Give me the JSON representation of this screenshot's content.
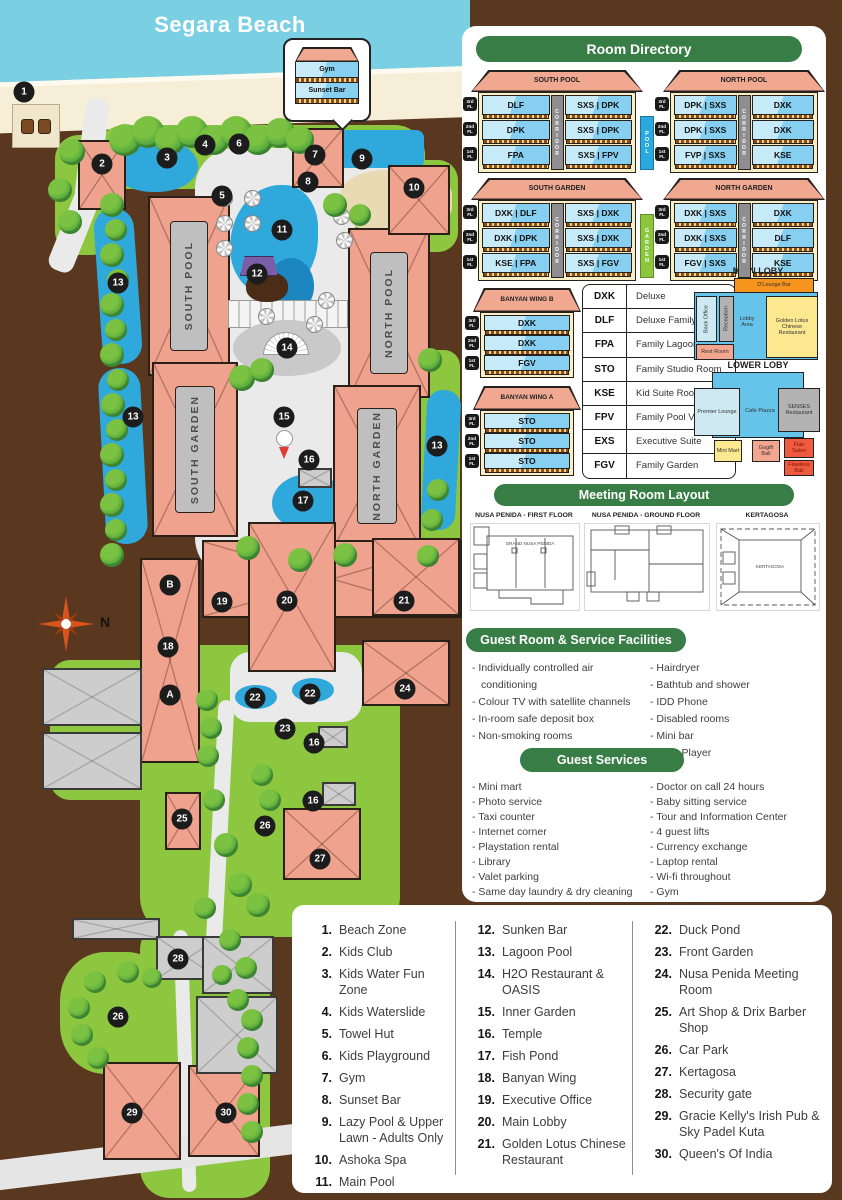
{
  "map": {
    "beach_label": "Segara Beach",
    "compass_label": "N",
    "callout_rows": [
      "Gym",
      "Sunset Bar"
    ],
    "building_labels": [
      "SOUTH POOL",
      "NORTH POOL",
      "SOUTH GARDEN",
      "NORTH GARDEN"
    ],
    "markers": [
      {
        "n": "1",
        "x": 24,
        "y": 92
      },
      {
        "n": "2",
        "x": 102,
        "y": 164
      },
      {
        "n": "3",
        "x": 167,
        "y": 158
      },
      {
        "n": "4",
        "x": 205,
        "y": 145
      },
      {
        "n": "5",
        "x": 222,
        "y": 196
      },
      {
        "n": "6",
        "x": 239,
        "y": 144
      },
      {
        "n": "7",
        "x": 315,
        "y": 155
      },
      {
        "n": "8",
        "x": 308,
        "y": 182
      },
      {
        "n": "9",
        "x": 362,
        "y": 159
      },
      {
        "n": "10",
        "x": 414,
        "y": 188
      },
      {
        "n": "11",
        "x": 282,
        "y": 230
      },
      {
        "n": "12",
        "x": 257,
        "y": 274
      },
      {
        "n": "13",
        "x": 118,
        "y": 283
      },
      {
        "n": "13",
        "x": 133,
        "y": 417
      },
      {
        "n": "13",
        "x": 437,
        "y": 446
      },
      {
        "n": "14",
        "x": 287,
        "y": 348
      },
      {
        "n": "15",
        "x": 284,
        "y": 417
      },
      {
        "n": "16",
        "x": 309,
        "y": 460
      },
      {
        "n": "16",
        "x": 314,
        "y": 743
      },
      {
        "n": "16",
        "x": 313,
        "y": 801
      },
      {
        "n": "17",
        "x": 303,
        "y": 501
      },
      {
        "n": "18",
        "x": 168,
        "y": 647
      },
      {
        "n": "19",
        "x": 222,
        "y": 602
      },
      {
        "n": "20",
        "x": 287,
        "y": 601
      },
      {
        "n": "21",
        "x": 404,
        "y": 601
      },
      {
        "n": "22",
        "x": 255,
        "y": 698
      },
      {
        "n": "22",
        "x": 310,
        "y": 694
      },
      {
        "n": "23",
        "x": 285,
        "y": 729
      },
      {
        "n": "24",
        "x": 405,
        "y": 689
      },
      {
        "n": "25",
        "x": 182,
        "y": 819
      },
      {
        "n": "26",
        "x": 265,
        "y": 826
      },
      {
        "n": "26",
        "x": 118,
        "y": 1017
      },
      {
        "n": "27",
        "x": 320,
        "y": 859
      },
      {
        "n": "28",
        "x": 178,
        "y": 959
      },
      {
        "n": "29",
        "x": 132,
        "y": 1113
      },
      {
        "n": "30",
        "x": 226,
        "y": 1113
      },
      {
        "n": "A",
        "x": 170,
        "y": 695
      },
      {
        "n": "B",
        "x": 170,
        "y": 585
      }
    ]
  },
  "room_directory": {
    "title": "Room Directory",
    "floor_labels": [
      "3rd FL",
      "2nd FL",
      "1st FL"
    ],
    "corridor_label": "CORRIDOR",
    "buildings": [
      {
        "name": "SOUTH POOL",
        "left": [
          "DLF",
          "DPK",
          "FPA"
        ],
        "right": [
          "SXS | DPK",
          "SXS | DPK",
          "SXS | FPV"
        ],
        "side_label": "POOL",
        "side_color": "#29a9e0"
      },
      {
        "name": "NORTH POOL",
        "left": [
          "DPK | SXS",
          "DPK | SXS",
          "FVP | SXS"
        ],
        "right": [
          "DXK",
          "DXK",
          "KSE"
        ]
      },
      {
        "name": "SOUTH GARDEN",
        "left": [
          "DXK | DLF",
          "DXK | DPK",
          "KSE | FPA"
        ],
        "right": [
          "SXS | DXK",
          "SXS | DXK",
          "SXS | FGV"
        ],
        "side_label": "GARDEN",
        "side_color": "#8cc63f"
      },
      {
        "name": "NORTH GARDEN",
        "left": [
          "DXK | SXS",
          "DXK | SXS",
          "FGV | SXS"
        ],
        "right": [
          "DXK",
          "DLF",
          "KSE"
        ]
      }
    ],
    "wings": [
      {
        "name": "BANYAN WING B",
        "rooms": [
          "DXK",
          "DXK",
          "FGV"
        ]
      },
      {
        "name": "BANYAN WING A",
        "rooms": [
          "STO",
          "STO",
          "STO"
        ]
      }
    ],
    "room_codes": [
      {
        "code": "DXK",
        "name": "Deluxe"
      },
      {
        "code": "DLF",
        "name": "Deluxe Family"
      },
      {
        "code": "FPA",
        "name": "Family Lagoon Pool"
      },
      {
        "code": "STO",
        "name": "Family Studio Room"
      },
      {
        "code": "KSE",
        "name": "Kid Suite Room"
      },
      {
        "code": "FPV",
        "name": "Family Pool View"
      },
      {
        "code": "EXS",
        "name": "Executive Suite"
      },
      {
        "code": "FGV",
        "name": "Family Garden"
      }
    ]
  },
  "lobby": {
    "main": {
      "title": "MAIN LOBY",
      "rooms": [
        {
          "id": "dlounge",
          "label": "D'Lounge Bar",
          "color": "#f7941e"
        },
        {
          "id": "backoffice",
          "label": "Back Office",
          "color": "#cfe9f2"
        },
        {
          "id": "reception",
          "label": "Reception",
          "color": "#b3b3b3"
        },
        {
          "id": "lobbyarea",
          "label": "Lobby Area",
          "color": "#66c3ea"
        },
        {
          "id": "goldenlotus",
          "label": "Golden Lotus Chinese Restaurant",
          "color": "#fce98f"
        },
        {
          "id": "restroom",
          "label": "Rest Room",
          "color": "#f2a68f"
        }
      ]
    },
    "lower": {
      "title": "LOWER LOBY",
      "rooms": [
        {
          "id": "premier",
          "label": "Premier Lounge",
          "color": "#cfe9f2"
        },
        {
          "id": "cafe",
          "label": "Cafe Piazza",
          "color": "#66c3ea"
        },
        {
          "id": "senses",
          "label": "SENSES Restaurant",
          "color": "#b3b3b3"
        },
        {
          "id": "minimart",
          "label": "Mini Mart",
          "color": "#fce98f"
        },
        {
          "id": "gogift",
          "label": "Gogift Bali",
          "color": "#f2a68f"
        },
        {
          "id": "flair",
          "label": "Flair Salon",
          "color": "#f05a40"
        },
        {
          "id": "flawless",
          "label": "Flawless Bali",
          "color": "#f05a40"
        }
      ]
    }
  },
  "meeting": {
    "title": "Meeting Room Layout",
    "plans": [
      {
        "title": "NUSA PENIDA - FIRST FLOOR",
        "inner_label": "GRAND NUSA PENIDA"
      },
      {
        "title": "NUSA PENIDA - GROUND FLOOR",
        "inner_label": ""
      },
      {
        "title": "KERTAGOSA",
        "inner_label": "KERTAGOSA"
      }
    ]
  },
  "facilities": {
    "title": "Guest Room & Service Facilities",
    "left": [
      "Individually controlled air conditioning",
      "Colour TV with satellite channels",
      "In-room safe deposit box",
      "Non-smoking rooms"
    ],
    "right": [
      "Hairdryer",
      "Bathtub and shower",
      "IDD Phone",
      "Disabled rooms",
      "Mini bar",
      "DVD Player"
    ]
  },
  "services": {
    "title": "Guest Services",
    "left": [
      "Mini mart",
      "Photo service",
      "Taxi counter",
      "Internet corner",
      "Playstation rental",
      "Library",
      "Valet parking",
      "Same day laundry & dry cleaning"
    ],
    "right": [
      "Doctor on call 24 hours",
      "Baby sitting service",
      "Tour and Information Center",
      "4 guest lifts",
      "Currency exchange",
      "Laptop rental",
      "Wi-fi throughout",
      "Gym",
      "Gaming Room"
    ]
  },
  "legend": {
    "columns": [
      [
        {
          "n": "1.",
          "label": "Beach Zone"
        },
        {
          "n": "2.",
          "label": "Kids Club"
        },
        {
          "n": "3.",
          "label": "Kids Water Fun Zone"
        },
        {
          "n": "4.",
          "label": "Kids Waterslide"
        },
        {
          "n": "5.",
          "label": "Towel Hut"
        },
        {
          "n": "6.",
          "label": "Kids Playground"
        },
        {
          "n": "7.",
          "label": "Gym"
        },
        {
          "n": "8.",
          "label": "Sunset Bar"
        },
        {
          "n": "9.",
          "label": "Lazy Pool & Upper Lawn - Adults Only"
        },
        {
          "n": "10.",
          "label": "Ashoka Spa"
        },
        {
          "n": "11.",
          "label": "Main Pool"
        }
      ],
      [
        {
          "n": "12.",
          "label": "Sunken Bar"
        },
        {
          "n": "13.",
          "label": "Lagoon Pool"
        },
        {
          "n": "14.",
          "label": "H2O Restaurant & OASIS"
        },
        {
          "n": "15.",
          "label": "Inner Garden"
        },
        {
          "n": "16.",
          "label": "Temple"
        },
        {
          "n": "17.",
          "label": "Fish Pond"
        },
        {
          "n": "18.",
          "label": "Banyan Wing"
        },
        {
          "n": "19.",
          "label": "Executive Office"
        },
        {
          "n": "20.",
          "label": "Main Lobby"
        },
        {
          "n": "21.",
          "label": "Golden Lotus Chinese Restaurant"
        }
      ],
      [
        {
          "n": "22.",
          "label": "Duck Pond"
        },
        {
          "n": "23.",
          "label": "Front Garden"
        },
        {
          "n": "24.",
          "label": "Nusa Penida Meeting Room"
        },
        {
          "n": "25.",
          "label": "Art Shop & Drix Barber Shop"
        },
        {
          "n": "26.",
          "label": "Car Park"
        },
        {
          "n": "27.",
          "label": "Kertagosa"
        },
        {
          "n": "28.",
          "label": "Security gate"
        },
        {
          "n": "29.",
          "label": "Gracie Kelly's Irish Pub & Sky Padel Kuta"
        },
        {
          "n": "30.",
          "label": "Queen's Of India"
        }
      ]
    ]
  },
  "colors": {
    "accent_green": "#377d45",
    "roof_salmon": "#efa28e",
    "pool_blue": "#2fa8dc",
    "marker_black": "#1c1c1c"
  }
}
